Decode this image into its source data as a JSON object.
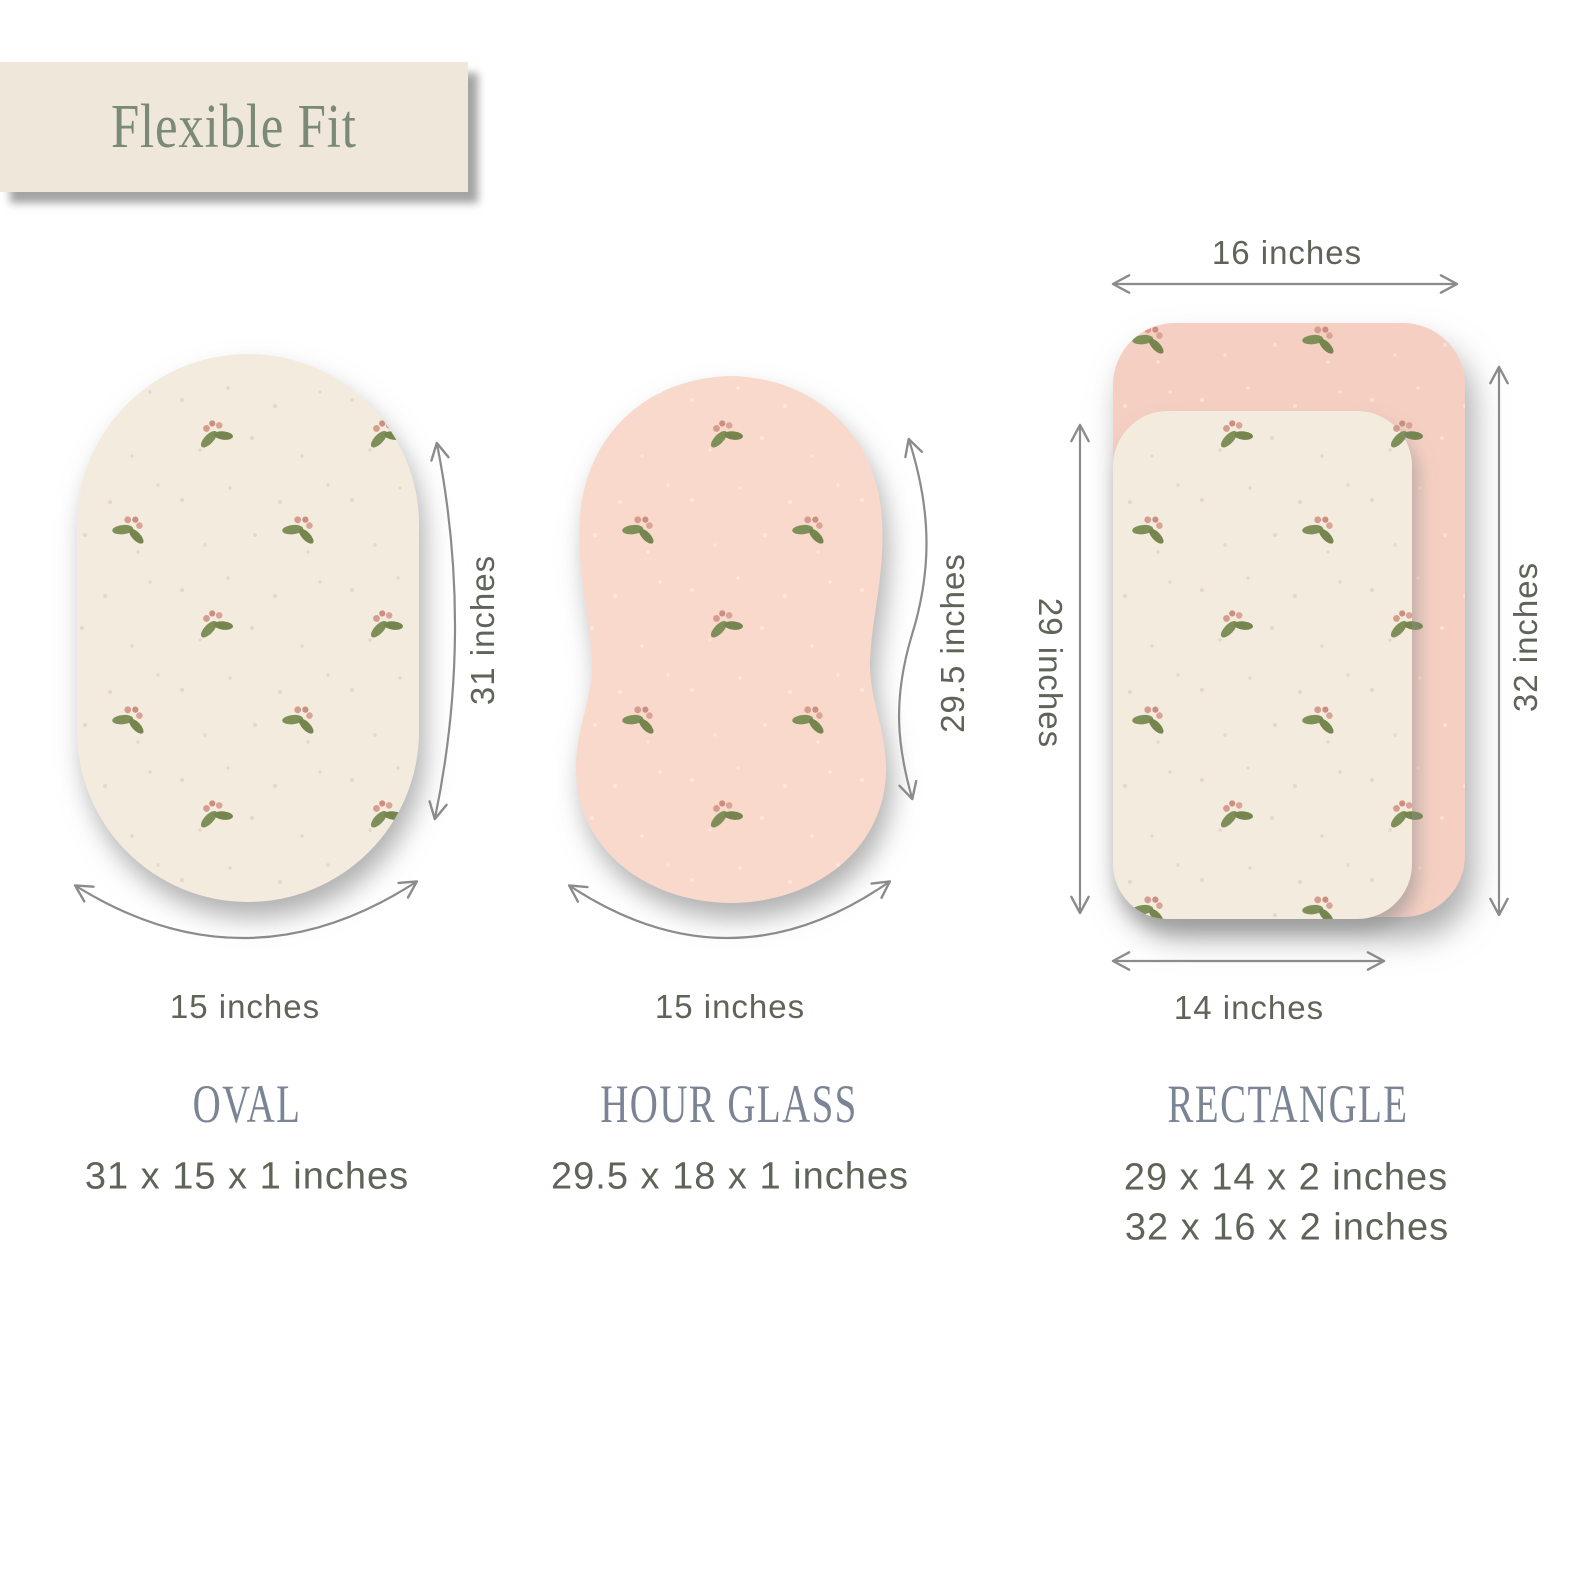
{
  "canvas": {
    "bg": "#FFFFFF"
  },
  "header": {
    "title": "Flexible Fit"
  },
  "colors": {
    "canvas_bg": "#FFFFFF",
    "title_box_bg": "#EFE8DA",
    "title_text": "#7A8A76",
    "shape_name_text": "#7A8494",
    "dimension_text": "#5F6458",
    "arrow": "#8B8B8B",
    "cream": "#F2EBDE",
    "pink_hourglass": "#F8D9CB",
    "pink_rect": "#F5CFC2",
    "leaf_green": "#7E9058",
    "berry_pink": "#D69C8D"
  },
  "oval": {
    "name": "OVAL",
    "size_label": "31 x 15 x 1 inches",
    "height_label": "31 inches",
    "width_label": "15 inches"
  },
  "hourglass": {
    "name": "HOUR GLASS",
    "size_label": "29.5 x 18 x 1 inches",
    "height_label": "29.5 inches",
    "width_label": "15 inches"
  },
  "rectangle": {
    "name": "RECTANGLE",
    "size_label_small": "29 x 14 x 2 inches",
    "size_label_large": "32 x 16 x 2 inches",
    "small_height_label": "29 inches",
    "small_width_label": "14 inches",
    "large_height_label": "32 inches",
    "large_width_label": "16 inches"
  }
}
